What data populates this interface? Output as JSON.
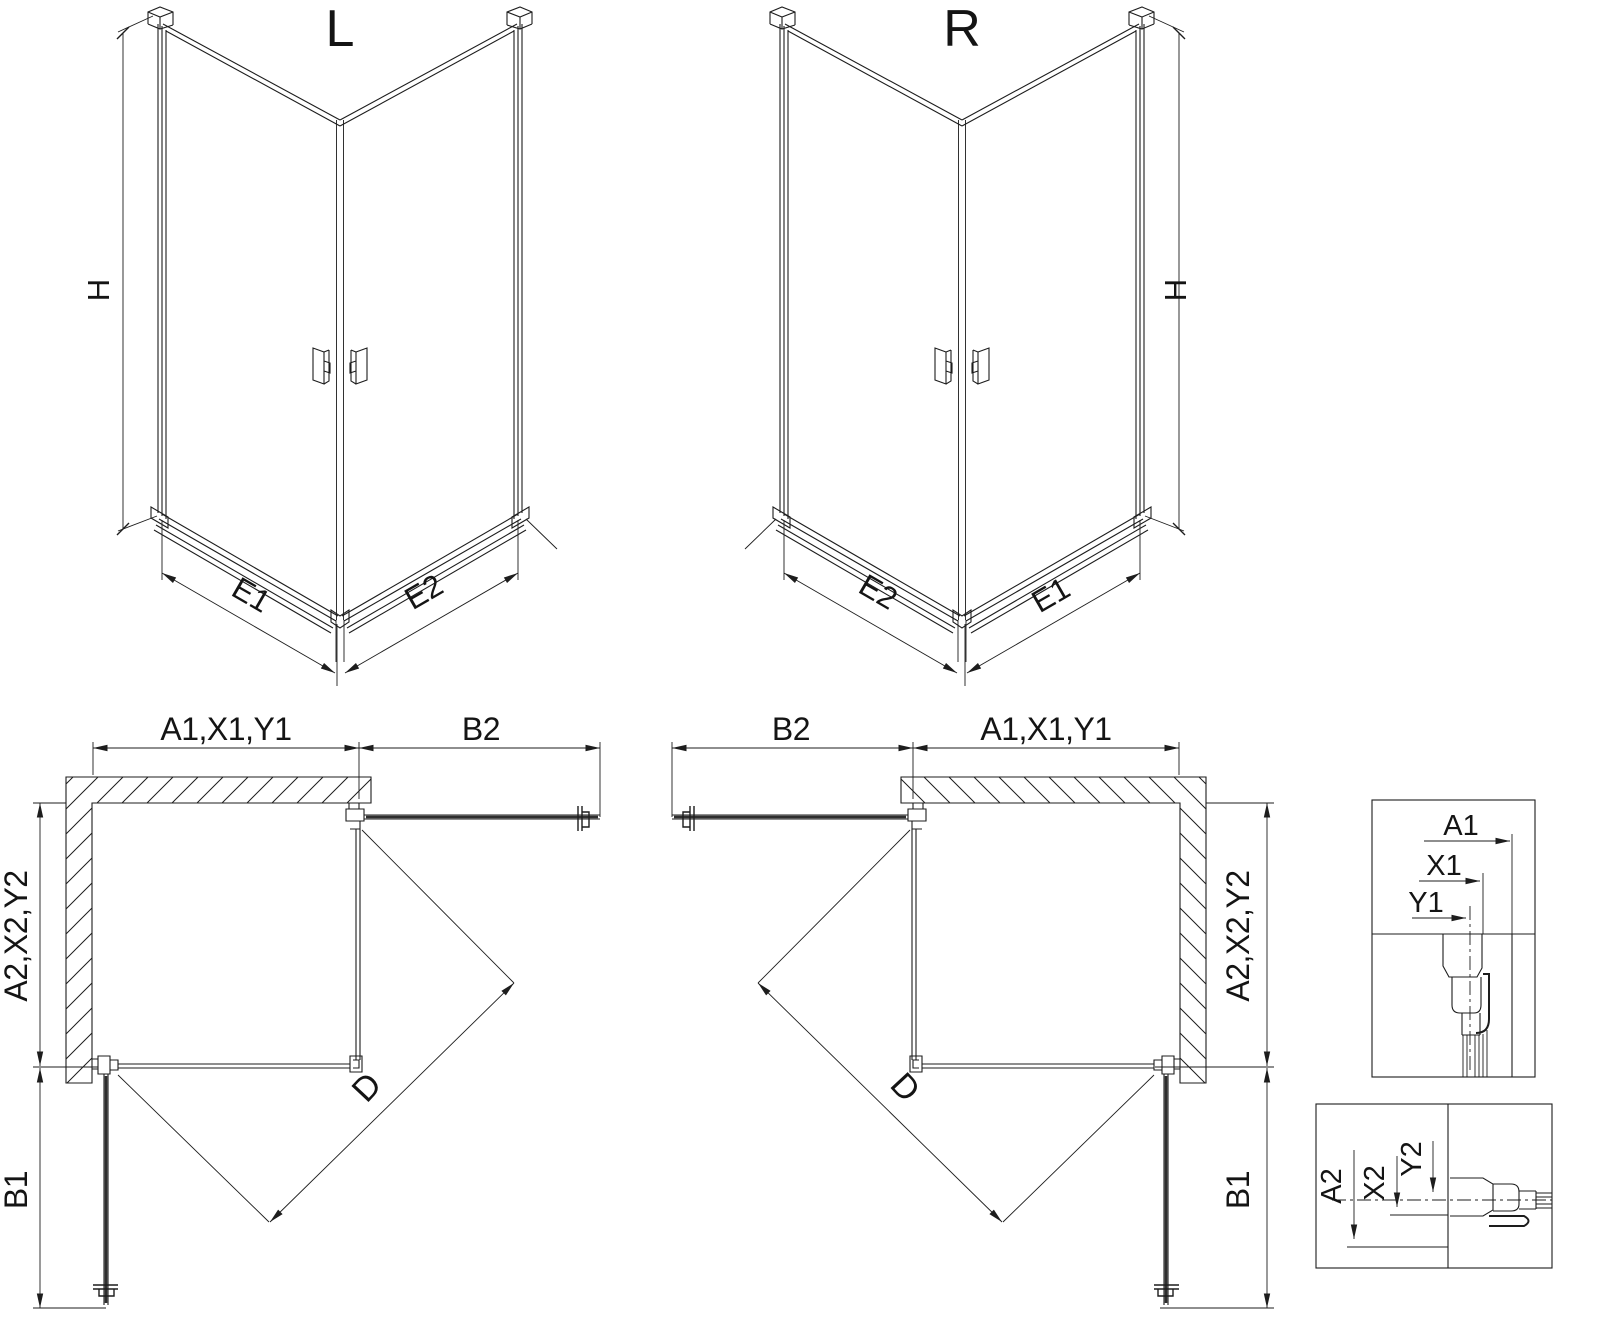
{
  "colors": {
    "background": "#ffffff",
    "line": "#1d1d1d"
  },
  "iso_left": {
    "title": "L",
    "height_label": "H",
    "bottom_left_label": "E1",
    "bottom_right_label": "E2"
  },
  "iso_right": {
    "title": "R",
    "height_label": "H",
    "bottom_left_label": "E2",
    "bottom_right_label": "E1"
  },
  "plan_left": {
    "wall_width_label": "A1,X1,Y1",
    "door_open_top_label": "B2",
    "wall_depth_label": "A2,X2,Y2",
    "door_open_side_label": "B1",
    "diagonal_label": "D"
  },
  "plan_right": {
    "door_open_top_label": "B2",
    "wall_width_label": "A1,X1,Y1",
    "wall_depth_label": "A2,X2,Y2",
    "door_open_side_label": "B1",
    "diagonal_label": "D"
  },
  "detail_top_profile": {
    "labels": [
      "A1",
      "X1",
      "Y1"
    ]
  },
  "detail_side_profile": {
    "labels": [
      "A2",
      "X2",
      "Y2"
    ]
  }
}
